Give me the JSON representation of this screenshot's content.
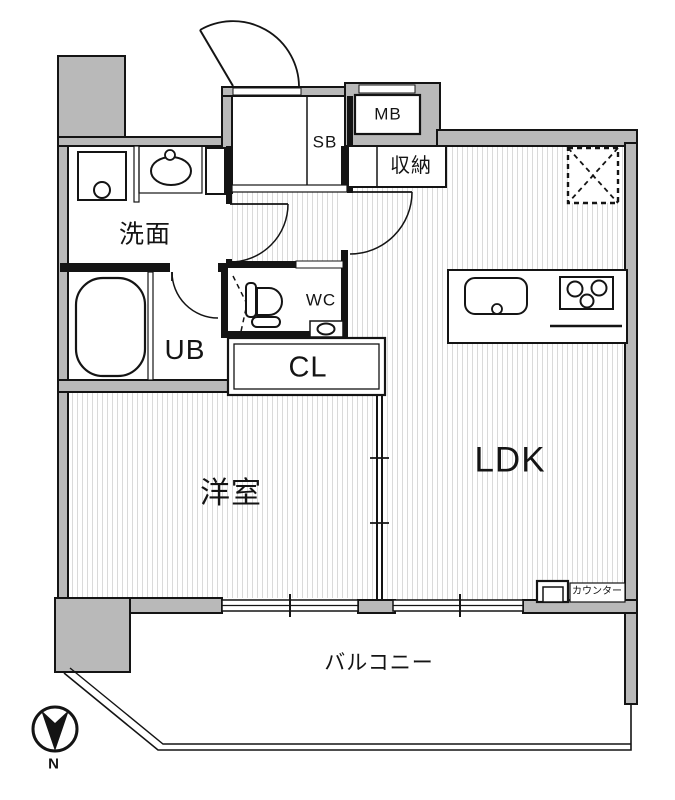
{
  "title": "間取り図",
  "labels": {
    "washroom": "洗面",
    "unit_bath": "UB",
    "toilet": "WC",
    "closet": "CL",
    "shoe_box": "SB",
    "meter_box": "MB",
    "storage": "収納",
    "living_dining_kitchen": "LDK",
    "western_room": "洋室",
    "balcony": "バルコニー",
    "counter": "カウンター",
    "compass_north": "N"
  },
  "colors": {
    "wall_fill": "#b9b9b9",
    "line": "#141414",
    "hatch": "#dadada",
    "background": "#ffffff"
  }
}
